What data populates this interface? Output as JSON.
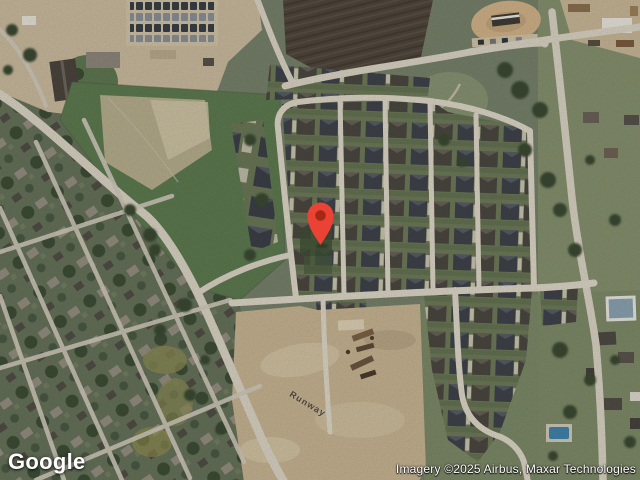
{
  "map": {
    "logo": "Google",
    "attribution": "Imagery ©2025 Airbus, Maxar Technologies",
    "road_labels": [
      {
        "text": "Runway"
      }
    ],
    "marker": {
      "color": "#EA4335",
      "inner_color": "#A52714"
    }
  },
  "colors": {
    "road": "#d9d3c3",
    "grass_base": "#76816a",
    "field_green": "#5d7a50",
    "dirt_tan": "#c6b391",
    "plowed_field": "#50473c",
    "roof_dark": "#3f434a"
  }
}
